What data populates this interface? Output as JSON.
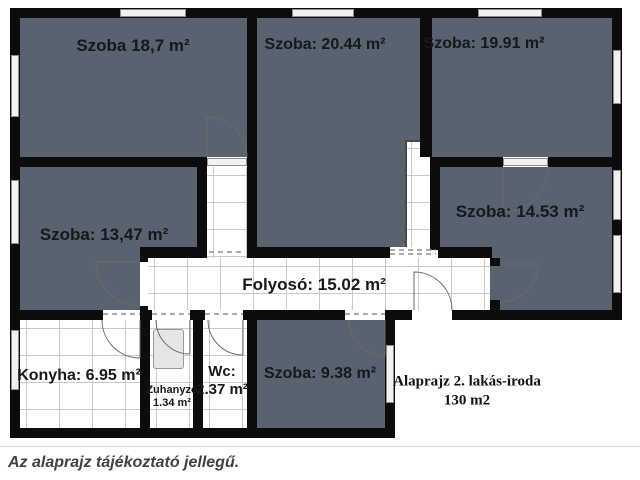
{
  "rooms": {
    "szoba_18_7": "Szoba 18,7 m²",
    "szoba_20_44": "Szoba: 20.44 m²",
    "szoba_19_91": "Szoba: 19.91 m²",
    "szoba_13_47": "Szoba: 13,47 m²",
    "szoba_14_53": "Szoba: 14.53 m²",
    "folyoso": "Folyosó: 15.02 m²",
    "konyha": "Konyha: 6.95 m²",
    "zuhanyzo_name": "Zuhanyzó",
    "zuhanyzo_area": "1.34 m²",
    "wc_name": "Wc:",
    "wc_area": "2.37 m²",
    "szoba_9_38": "Szoba: 9.38 m²"
  },
  "annotation": {
    "line1": "Alaprajz 2. lakás-iroda",
    "line2": "130 m2"
  },
  "caption": "Az alaprajz tájékoztató jellegű.",
  "colors": {
    "room_fill": "#59626f",
    "wall": "#0c0c0c",
    "grid_line": "#c9c9c9",
    "window_fill": "#f1f1f1",
    "window_frame": "#8e8e8e",
    "door_arc": "#6b6b6b",
    "label": "#15181d",
    "caption": "#3e4147",
    "separator": "#d8d8d8"
  }
}
